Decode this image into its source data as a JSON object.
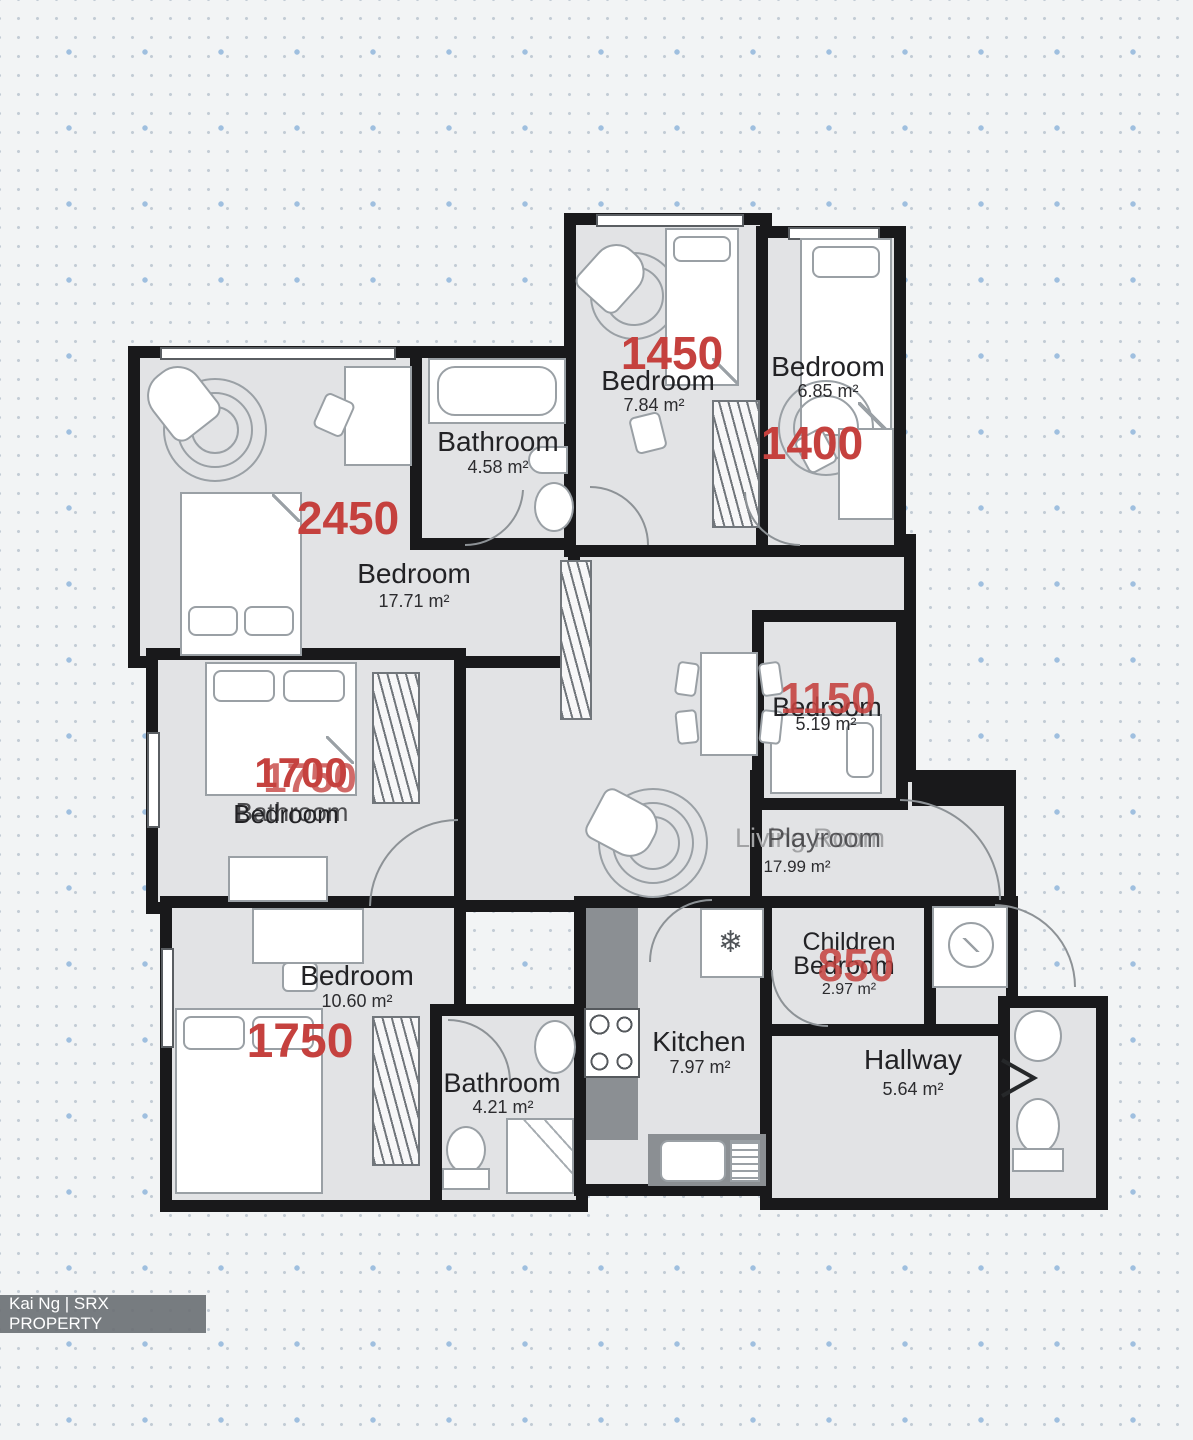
{
  "colors": {
    "price_red": "#c5413e",
    "wall_black": "#19191b",
    "floor_gray": "#e2e3e5"
  },
  "rooms": [
    {
      "label": "Bedroom",
      "area": "17.71 m²",
      "price": "2450"
    },
    {
      "label": "Bathroom",
      "area": "4.58 m²"
    },
    {
      "label": "Bedroom",
      "area": "7.84 m²",
      "price": "1450"
    },
    {
      "label": "Bedroom",
      "area": "6.85 m²",
      "price": "1400"
    },
    {
      "label": "Bedroom",
      "ghost_label": "Bathroom",
      "price": "1700",
      "ghost_price": "1750"
    },
    {
      "label": "Bedroom",
      "area": "5.19 m²",
      "price": "1150"
    },
    {
      "label": "Living Room",
      "ghost_label": "Playroom",
      "area": "17.99 m²"
    },
    {
      "label": "Bedroom",
      "area": "10.60 m²",
      "price": "1750"
    },
    {
      "label": "Bathroom",
      "area": "4.21 m²"
    },
    {
      "label": "Kitchen",
      "area": "7.97 m²"
    },
    {
      "label": "Children",
      "label_line2": "Bedroom",
      "area": "2.97 m²",
      "price": "850"
    },
    {
      "label": "Hallway",
      "area": "5.64 m²"
    }
  ],
  "icons": {
    "fridge_snowflake": "❄"
  },
  "watermark": {
    "credit": "Kai Ng | SRX PROPERTY"
  }
}
